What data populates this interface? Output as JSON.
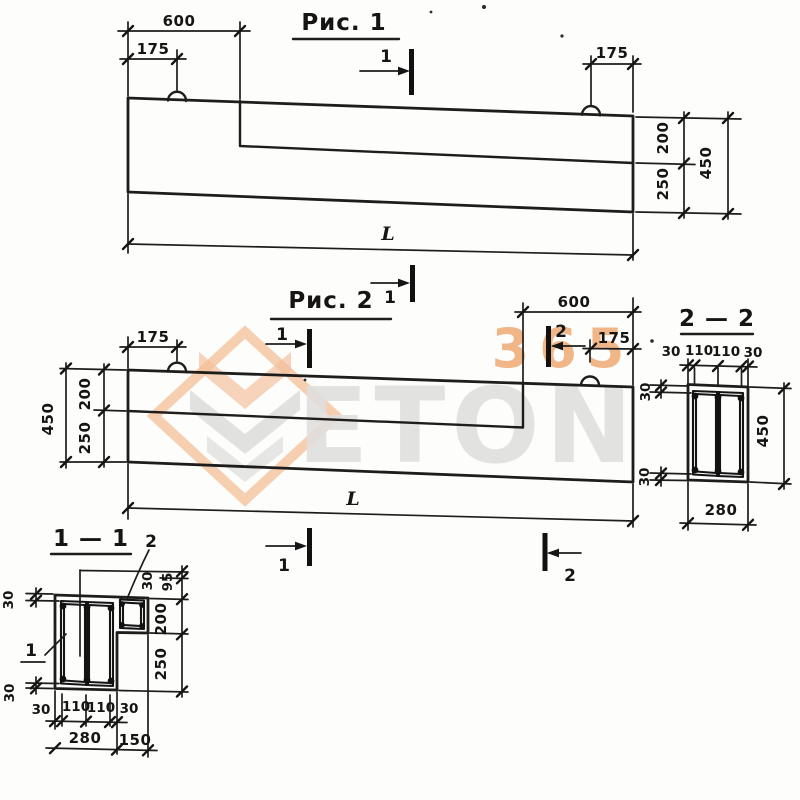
{
  "watermark": {
    "number": "365",
    "brand": "ETON",
    "orange": "#ea9a5c",
    "grey": "#dcdcda"
  },
  "figure1": {
    "title": "Рис. 1",
    "cut_top": "1",
    "cut_bottom": "1",
    "dim_600": "600",
    "dim_175_left": "175",
    "dim_175_right": "175",
    "dim_200": "200",
    "dim_250": "250",
    "dim_450": "450",
    "dim_length": "L"
  },
  "figure2": {
    "title": "Рис. 2",
    "cut1_top": "1",
    "cut2_top": "2",
    "cut1_bottom": "1",
    "cut2_bottom": "2",
    "dim_175_left": "175",
    "dim_600": "600",
    "dim_175_right": "175",
    "dim_200": "200",
    "dim_250": "250",
    "dim_450": "450",
    "dim_length": "L"
  },
  "section_2_2": {
    "title": "2 — 2",
    "top_dims": [
      "30",
      "110",
      "110",
      "30"
    ],
    "cover_top": "30",
    "cover_bottom": "30",
    "dim_height": "450",
    "dim_width": "280"
  },
  "section_1_1": {
    "title": "1 — 1",
    "label_main_cage": "1",
    "label_ledge_cage": "2",
    "cover_top": "30",
    "cover_bottom": "30",
    "right_dims": [
      "30",
      "95",
      "200",
      "250"
    ],
    "bottom_dims": [
      "30",
      "110",
      "110",
      "30"
    ],
    "dim_width": "280",
    "dim_ledge": "150"
  }
}
